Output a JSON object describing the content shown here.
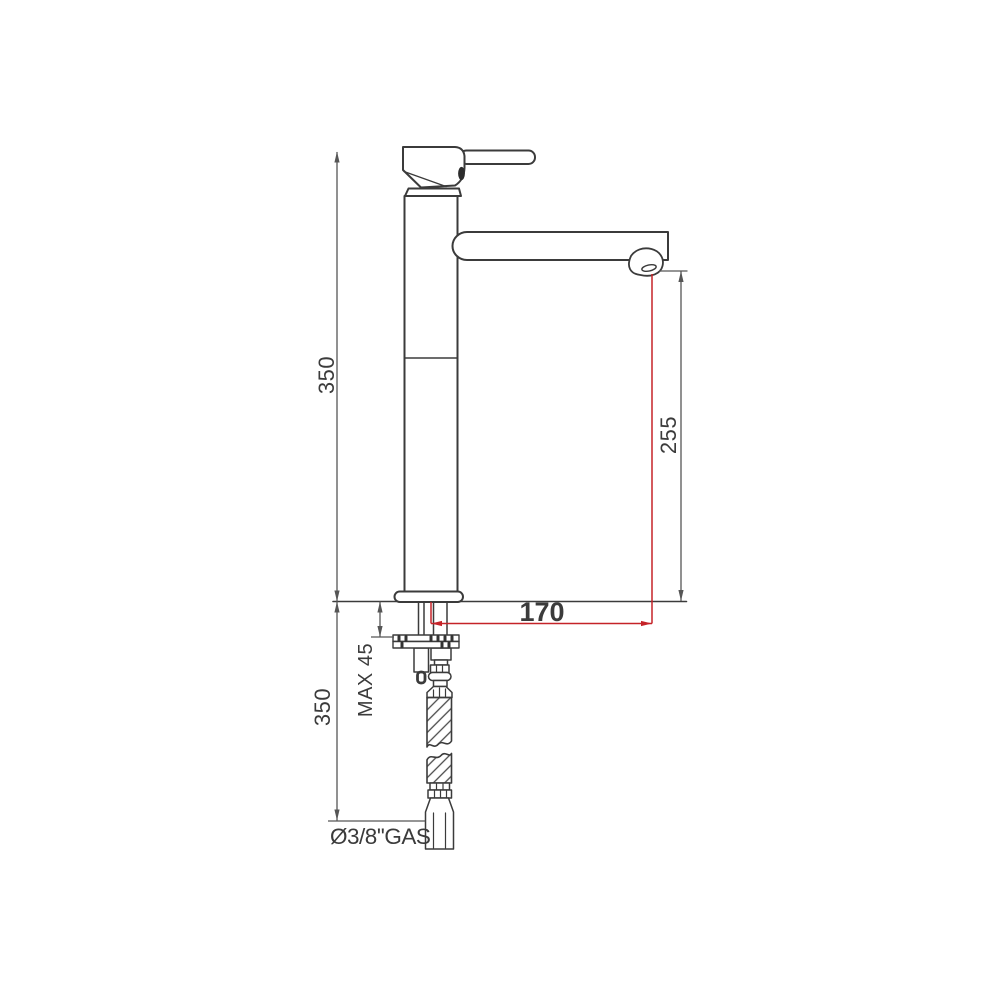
{
  "meta": {
    "title": "Tall single-lever basin mixer tap — dimensioned side elevation",
    "drawing_type": "technical line drawing"
  },
  "colors": {
    "outline": "#3b3b3b",
    "dimension": "#565656",
    "accent_red": "#c52328",
    "background": "#ffffff"
  },
  "labels": {
    "height_above_counter": "350",
    "spout_outlet_height": "255",
    "spout_reach": "170",
    "max_counter_thickness": "MAX 45",
    "length_below_counter": "350",
    "connection_size": "Ø3/8''GAS"
  }
}
